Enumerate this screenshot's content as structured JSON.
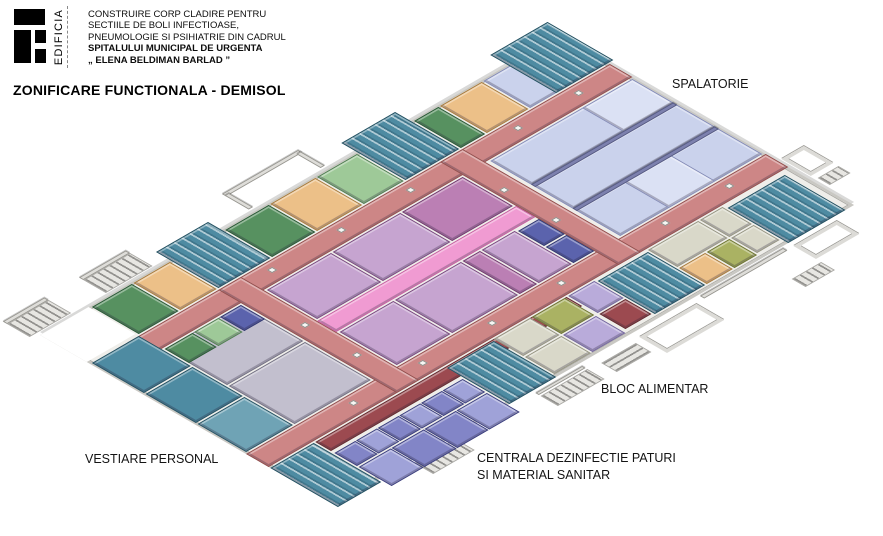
{
  "header": {
    "logo": "EDIFICIA",
    "project_lines": [
      "CONSTRUIRE CORP CLADIRE PENTRU",
      "SECTIILE DE BOLI INFECTIOASE,",
      "PNEUMOLOGIE SI PSIHIATRIE DIN CADRUL",
      "SPITALULUI MUNICIPAL DE URGENTA",
      "„ ELENA BELDIMAN BARLAD ”"
    ],
    "title": "ZONIFICARE FUNCTIONALA - DEMISOL"
  },
  "plan_labels": {
    "spalatorie": "SPALATORIE",
    "bloc_alimentar": "BLOC ALIMENTAR",
    "centrala": "CENTRALA DEZINFECTIE PATURI\nSI MATERIAL SANITAR",
    "vestiare": "VESTIARE PERSONAL"
  },
  "plan": {
    "palette": {
      "slab": {
        "floor": "#efeeea",
        "wall": "#b3b2ad"
      },
      "white": {
        "floor": "#ffffff",
        "wall": "#ffffff"
      },
      "red": {
        "floor": "#cd8686",
        "wall": "#8f4e4c"
      },
      "pinkbright": {
        "floor": "#f09bd2",
        "wall": "#c2609e"
      },
      "maroon": {
        "floor": "#9c4a50",
        "wall": "#5f2d31"
      },
      "teal": {
        "floor": "#4e8ba2",
        "wall": "#27505f"
      },
      "tealLt": {
        "floor": "#6fa3b5",
        "wall": "#27505f"
      },
      "green": {
        "floor": "#579160",
        "wall": "#2c5738"
      },
      "ltgreen": {
        "floor": "#9ec998",
        "wall": "#4f7a52"
      },
      "orange": {
        "floor": "#ecc088",
        "wall": "#a3793d"
      },
      "olive": {
        "floor": "#aab263",
        "wall": "#6d7436"
      },
      "mauve": {
        "floor": "#c6a4d0",
        "wall": "#76477a"
      },
      "magenta": {
        "floor": "#bb7fb4",
        "wall": "#6e3a6b"
      },
      "lavender": {
        "floor": "#cad2ec",
        "wall": "#8289b5"
      },
      "lavenderLt": {
        "floor": "#dbe1f4",
        "wall": "#8289b5"
      },
      "slate": {
        "floor": "#7d81ae",
        "wall": "#565a82"
      },
      "blue": {
        "floor": "#5b63ad",
        "wall": "#343a6e"
      },
      "indigo": {
        "floor": "#8285c7",
        "wall": "#3a3d78"
      },
      "indigoLt": {
        "floor": "#9fa2d8",
        "wall": "#3a3d78"
      },
      "greylav": {
        "floor": "#c2bfce",
        "wall": "#6f6d7e"
      },
      "ltpurple": {
        "floor": "#b9abda",
        "wall": "#71659a"
      },
      "beige": {
        "floor": "#d9d8c9",
        "wall": "#92917f"
      },
      "ext": {
        "floor": "#e7e6e2",
        "wall": "#a9a8a4"
      },
      "pillar": {
        "floor": "#f7f7f4",
        "wall": "#8a8a86"
      }
    },
    "rooms": [
      {
        "n": "building-slab",
        "u": 0,
        "v": 0,
        "w": 600,
        "h": 340,
        "z": "slab",
        "cls": "slab"
      },
      {
        "n": "terrain-patch",
        "u": 0,
        "v": 0,
        "w": 56,
        "h": 54,
        "z": "white",
        "cls": "patch"
      },
      {
        "n": "external-stairs",
        "u": -8,
        "v": -30,
        "w": 48,
        "h": 26,
        "z": "ext",
        "cls": "ext-stairs-u"
      },
      {
        "n": "external-wall",
        "u": -8,
        "v": -35,
        "w": 48,
        "h": 5,
        "z": "ext",
        "cls": "extwall"
      },
      {
        "n": "external-stairs",
        "u": 80,
        "v": -30,
        "w": 54,
        "h": 26,
        "z": "ext",
        "cls": "ext-stairs-u"
      },
      {
        "n": "external-wall",
        "u": 80,
        "v": -35,
        "w": 54,
        "h": 5,
        "z": "ext",
        "cls": "extwall"
      },
      {
        "n": "courtyard-wall",
        "u": 246,
        "v": -36,
        "w": 88,
        "h": 5,
        "z": "ext",
        "cls": "extwall"
      },
      {
        "n": "courtyard-wall",
        "u": 246,
        "v": -33,
        "w": 5,
        "h": 28,
        "z": "ext",
        "cls": "extwall"
      },
      {
        "n": "courtyard-wall",
        "u": 329,
        "v": -33,
        "w": 5,
        "h": 28,
        "z": "ext",
        "cls": "extwall"
      },
      {
        "n": "external-stairs",
        "u": 88,
        "v": 344,
        "w": 48,
        "h": 22,
        "z": "ext",
        "cls": "ext-stairs-u"
      },
      {
        "n": "external-wall",
        "u": 228,
        "v": 344,
        "w": 54,
        "h": 4,
        "z": "ext",
        "cls": "extwall"
      },
      {
        "n": "external-stairs",
        "u": 228,
        "v": 350,
        "w": 54,
        "h": 20,
        "z": "ext",
        "cls": "ext-stairs-u"
      },
      {
        "n": "external-stairs",
        "u": 296,
        "v": 352,
        "w": 40,
        "h": 18,
        "z": "ext",
        "cls": "ext-stairs-v"
      },
      {
        "n": "courtyard",
        "u": 344,
        "v": 348,
        "w": 66,
        "h": 32,
        "z": "ext",
        "cls": "outline"
      },
      {
        "n": "external-wall",
        "u": 420,
        "v": 342,
        "w": 96,
        "h": 5,
        "z": "ext",
        "cls": "extwall"
      },
      {
        "n": "courtyard",
        "u": 524,
        "v": 346,
        "w": 50,
        "h": 26,
        "z": "ext",
        "cls": "outline"
      },
      {
        "n": "external-stairs",
        "u": 490,
        "v": 378,
        "w": 34,
        "h": 16,
        "z": "ext",
        "cls": "ext-stairs-u"
      },
      {
        "n": "courtyard",
        "u": 604,
        "v": 252,
        "w": 26,
        "h": 34,
        "z": "ext",
        "cls": "outline"
      },
      {
        "n": "external-stairs",
        "u": 606,
        "v": 292,
        "w": 24,
        "h": 14,
        "z": "ext",
        "cls": "ext-stairs-u"
      },
      {
        "n": "corridor",
        "u": 30,
        "v": 58,
        "w": 570,
        "h": 26,
        "z": "red"
      },
      {
        "n": "corridor",
        "u": 0,
        "v": 238,
        "w": 600,
        "h": 26,
        "z": "red"
      },
      {
        "n": "corridor",
        "u": 148,
        "v": 58,
        "w": 26,
        "h": 206,
        "z": "red"
      },
      {
        "n": "corridor",
        "u": 404,
        "v": 58,
        "w": 26,
        "h": 206,
        "z": "red"
      },
      {
        "n": "room",
        "u": 2,
        "v": 58,
        "w": 54,
        "h": 60,
        "z": "teal"
      },
      {
        "n": "room",
        "u": 2,
        "v": 120,
        "w": 54,
        "h": 58,
        "z": "teal"
      },
      {
        "n": "room",
        "u": 2,
        "v": 180,
        "w": 54,
        "h": 56,
        "z": "tealLt"
      },
      {
        "n": "room",
        "u": 58,
        "v": 2,
        "w": 46,
        "h": 54,
        "z": "green"
      },
      {
        "n": "room",
        "u": 106,
        "v": 2,
        "w": 42,
        "h": 54,
        "z": "orange"
      },
      {
        "n": "room",
        "u": 212,
        "v": 2,
        "w": 50,
        "h": 54,
        "z": "green"
      },
      {
        "n": "room",
        "u": 264,
        "v": 2,
        "w": 52,
        "h": 54,
        "z": "orange"
      },
      {
        "n": "room",
        "u": 318,
        "v": 2,
        "w": 46,
        "h": 54,
        "z": "ltgreen"
      },
      {
        "n": "room",
        "u": 430,
        "v": 2,
        "w": 28,
        "h": 54,
        "z": "green"
      },
      {
        "n": "room",
        "u": 460,
        "v": 2,
        "w": 48,
        "h": 54,
        "z": "orange"
      },
      {
        "n": "room",
        "u": 510,
        "v": 2,
        "w": 88,
        "h": 54,
        "z": "lavender"
      },
      {
        "n": "room",
        "u": 58,
        "v": 86,
        "w": 88,
        "h": 72,
        "z": "greylav"
      },
      {
        "n": "room",
        "u": 58,
        "v": 160,
        "w": 88,
        "h": 76,
        "z": "greylav"
      },
      {
        "n": "room",
        "u": 58,
        "v": 86,
        "w": 32,
        "h": 28,
        "z": "green"
      },
      {
        "n": "room",
        "u": 92,
        "v": 86,
        "w": 28,
        "h": 28,
        "z": "ltgreen"
      },
      {
        "n": "room",
        "u": 122,
        "v": 86,
        "w": 24,
        "h": 28,
        "z": "blue"
      },
      {
        "n": "room",
        "u": 176,
        "v": 86,
        "w": 74,
        "h": 58,
        "z": "mauve"
      },
      {
        "n": "room",
        "u": 252,
        "v": 86,
        "w": 78,
        "h": 58,
        "z": "mauve"
      },
      {
        "n": "room",
        "u": 332,
        "v": 86,
        "w": 70,
        "h": 58,
        "z": "magenta"
      },
      {
        "n": "room",
        "u": 176,
        "v": 170,
        "w": 62,
        "h": 66,
        "z": "mauve"
      },
      {
        "n": "room",
        "u": 240,
        "v": 170,
        "w": 76,
        "h": 66,
        "z": "mauve"
      },
      {
        "n": "room",
        "u": 318,
        "v": 170,
        "w": 20,
        "h": 66,
        "z": "magenta"
      },
      {
        "n": "room",
        "u": 340,
        "v": 170,
        "w": 38,
        "h": 66,
        "z": "mauve"
      },
      {
        "n": "room",
        "u": 380,
        "v": 172,
        "w": 24,
        "h": 30,
        "z": "blue"
      },
      {
        "n": "room",
        "u": 380,
        "v": 204,
        "w": 24,
        "h": 32,
        "z": "blue"
      },
      {
        "n": "corridor",
        "u": 174,
        "v": 146,
        "w": 230,
        "h": 22,
        "z": "pinkbright"
      },
      {
        "n": "room",
        "u": 434,
        "v": 86,
        "w": 164,
        "h": 48,
        "z": "lavender"
      },
      {
        "n": "room",
        "u": 434,
        "v": 136,
        "w": 164,
        "h": 46,
        "z": "lavender"
      },
      {
        "n": "room",
        "u": 434,
        "v": 184,
        "w": 164,
        "h": 52,
        "z": "lavender"
      },
      {
        "n": "room",
        "u": 540,
        "v": 86,
        "w": 58,
        "h": 48,
        "z": "lavenderLt"
      },
      {
        "n": "room",
        "u": 490,
        "v": 184,
        "w": 54,
        "h": 52,
        "z": "lavenderLt"
      },
      {
        "n": "interior-wall",
        "u": 434,
        "v": 133,
        "w": 164,
        "h": 5,
        "z": "slate",
        "cls": "wallstrip"
      },
      {
        "n": "interior-wall",
        "u": 434,
        "v": 181,
        "w": 164,
        "h": 5,
        "z": "slate",
        "cls": "wallstrip"
      },
      {
        "n": "corridor",
        "u": 52,
        "v": 266,
        "w": 290,
        "h": 18,
        "z": "maroon"
      },
      {
        "n": "room",
        "u": 52,
        "v": 288,
        "w": 24,
        "h": 26,
        "z": "indigo"
      },
      {
        "n": "room",
        "u": 77,
        "v": 288,
        "w": 24,
        "h": 26,
        "z": "indigoLt"
      },
      {
        "n": "room",
        "u": 102,
        "v": 288,
        "w": 24,
        "h": 26,
        "z": "indigo"
      },
      {
        "n": "room",
        "u": 127,
        "v": 288,
        "w": 24,
        "h": 26,
        "z": "indigoLt"
      },
      {
        "n": "room",
        "u": 152,
        "v": 288,
        "w": 24,
        "h": 26,
        "z": "indigo"
      },
      {
        "n": "room",
        "u": 177,
        "v": 288,
        "w": 23,
        "h": 26,
        "z": "indigoLt"
      },
      {
        "n": "room",
        "u": 52,
        "v": 316,
        "w": 37,
        "h": 38,
        "z": "indigoLt"
      },
      {
        "n": "room",
        "u": 90,
        "v": 316,
        "w": 37,
        "h": 38,
        "z": "indigo"
      },
      {
        "n": "room",
        "u": 128,
        "v": 316,
        "w": 36,
        "h": 38,
        "z": "indigo"
      },
      {
        "n": "room",
        "u": 165,
        "v": 316,
        "w": 35,
        "h": 38,
        "z": "indigoLt"
      },
      {
        "n": "room",
        "u": 258,
        "v": 266,
        "w": 42,
        "h": 34,
        "z": "beige"
      },
      {
        "n": "room",
        "u": 302,
        "v": 266,
        "w": 38,
        "h": 34,
        "z": "olive"
      },
      {
        "n": "room",
        "u": 258,
        "v": 302,
        "w": 42,
        "h": 34,
        "z": "beige"
      },
      {
        "n": "room",
        "u": 302,
        "v": 302,
        "w": 38,
        "h": 34,
        "z": "ltpurple"
      },
      {
        "n": "room",
        "u": 344,
        "v": 266,
        "w": 30,
        "h": 34,
        "z": "ltpurple"
      },
      {
        "n": "room",
        "u": 344,
        "v": 302,
        "w": 30,
        "h": 30,
        "z": "maroon"
      },
      {
        "n": "room",
        "u": 436,
        "v": 266,
        "w": 58,
        "h": 34,
        "z": "beige"
      },
      {
        "n": "room",
        "u": 436,
        "v": 302,
        "w": 30,
        "h": 32,
        "z": "orange"
      },
      {
        "n": "room",
        "u": 468,
        "v": 302,
        "w": 26,
        "h": 32,
        "z": "olive"
      },
      {
        "n": "room",
        "u": 496,
        "v": 266,
        "w": 26,
        "h": 34,
        "z": "beige"
      },
      {
        "n": "room",
        "u": 496,
        "v": 302,
        "w": 26,
        "h": 30,
        "z": "beige"
      },
      {
        "n": "stairwell",
        "u": 150,
        "v": -16,
        "w": 60,
        "h": 72,
        "z": "teal",
        "cls": "stairs"
      },
      {
        "n": "stairwell",
        "u": 366,
        "v": -18,
        "w": 62,
        "h": 74,
        "z": "teal",
        "cls": "stairs"
      },
      {
        "n": "stairwell",
        "u": 540,
        "v": -20,
        "w": 66,
        "h": 76,
        "z": "teal",
        "cls": "stairs"
      },
      {
        "n": "stairwell",
        "u": 0,
        "v": 266,
        "w": 50,
        "h": 78,
        "z": "teal",
        "cls": "stairs"
      },
      {
        "n": "stairwell",
        "u": 202,
        "v": 268,
        "w": 54,
        "h": 72,
        "z": "teal",
        "cls": "stairs"
      },
      {
        "n": "stairwell",
        "u": 376,
        "v": 268,
        "w": 58,
        "h": 66,
        "z": "teal",
        "cls": "stairs"
      },
      {
        "n": "stairwell",
        "u": 524,
        "v": 270,
        "w": 66,
        "h": 70,
        "z": "teal",
        "cls": "stairs"
      },
      {
        "n": "pillar",
        "u": 196,
        "v": 66,
        "w": 6,
        "h": 6,
        "z": "pillar",
        "cls": "pillar"
      },
      {
        "n": "pillar",
        "u": 276,
        "v": 66,
        "w": 6,
        "h": 6,
        "z": "pillar",
        "cls": "pillar"
      },
      {
        "n": "pillar",
        "u": 356,
        "v": 66,
        "w": 6,
        "h": 6,
        "z": "pillar",
        "cls": "pillar"
      },
      {
        "n": "pillar",
        "u": 480,
        "v": 66,
        "w": 6,
        "h": 6,
        "z": "pillar",
        "cls": "pillar"
      },
      {
        "n": "pillar",
        "u": 550,
        "v": 66,
        "w": 6,
        "h": 6,
        "z": "pillar",
        "cls": "pillar"
      },
      {
        "n": "pillar",
        "u": 110,
        "v": 246,
        "w": 6,
        "h": 6,
        "z": "pillar",
        "cls": "pillar"
      },
      {
        "n": "pillar",
        "u": 190,
        "v": 246,
        "w": 6,
        "h": 6,
        "z": "pillar",
        "cls": "pillar"
      },
      {
        "n": "pillar",
        "u": 270,
        "v": 246,
        "w": 6,
        "h": 6,
        "z": "pillar",
        "cls": "pillar"
      },
      {
        "n": "pillar",
        "u": 350,
        "v": 246,
        "w": 6,
        "h": 6,
        "z": "pillar",
        "cls": "pillar"
      },
      {
        "n": "pillar",
        "u": 470,
        "v": 246,
        "w": 6,
        "h": 6,
        "z": "pillar",
        "cls": "pillar"
      },
      {
        "n": "pillar",
        "u": 544,
        "v": 246,
        "w": 6,
        "h": 6,
        "z": "pillar",
        "cls": "pillar"
      },
      {
        "n": "pillar",
        "u": 160,
        "v": 140,
        "w": 6,
        "h": 6,
        "z": "pillar",
        "cls": "pillar"
      },
      {
        "n": "pillar",
        "u": 160,
        "v": 200,
        "w": 6,
        "h": 6,
        "z": "pillar",
        "cls": "pillar"
      },
      {
        "n": "pillar",
        "u": 410,
        "v": 120,
        "w": 6,
        "h": 6,
        "z": "pillar",
        "cls": "pillar"
      },
      {
        "n": "pillar",
        "u": 410,
        "v": 180,
        "w": 6,
        "h": 6,
        "z": "pillar",
        "cls": "pillar"
      }
    ]
  }
}
